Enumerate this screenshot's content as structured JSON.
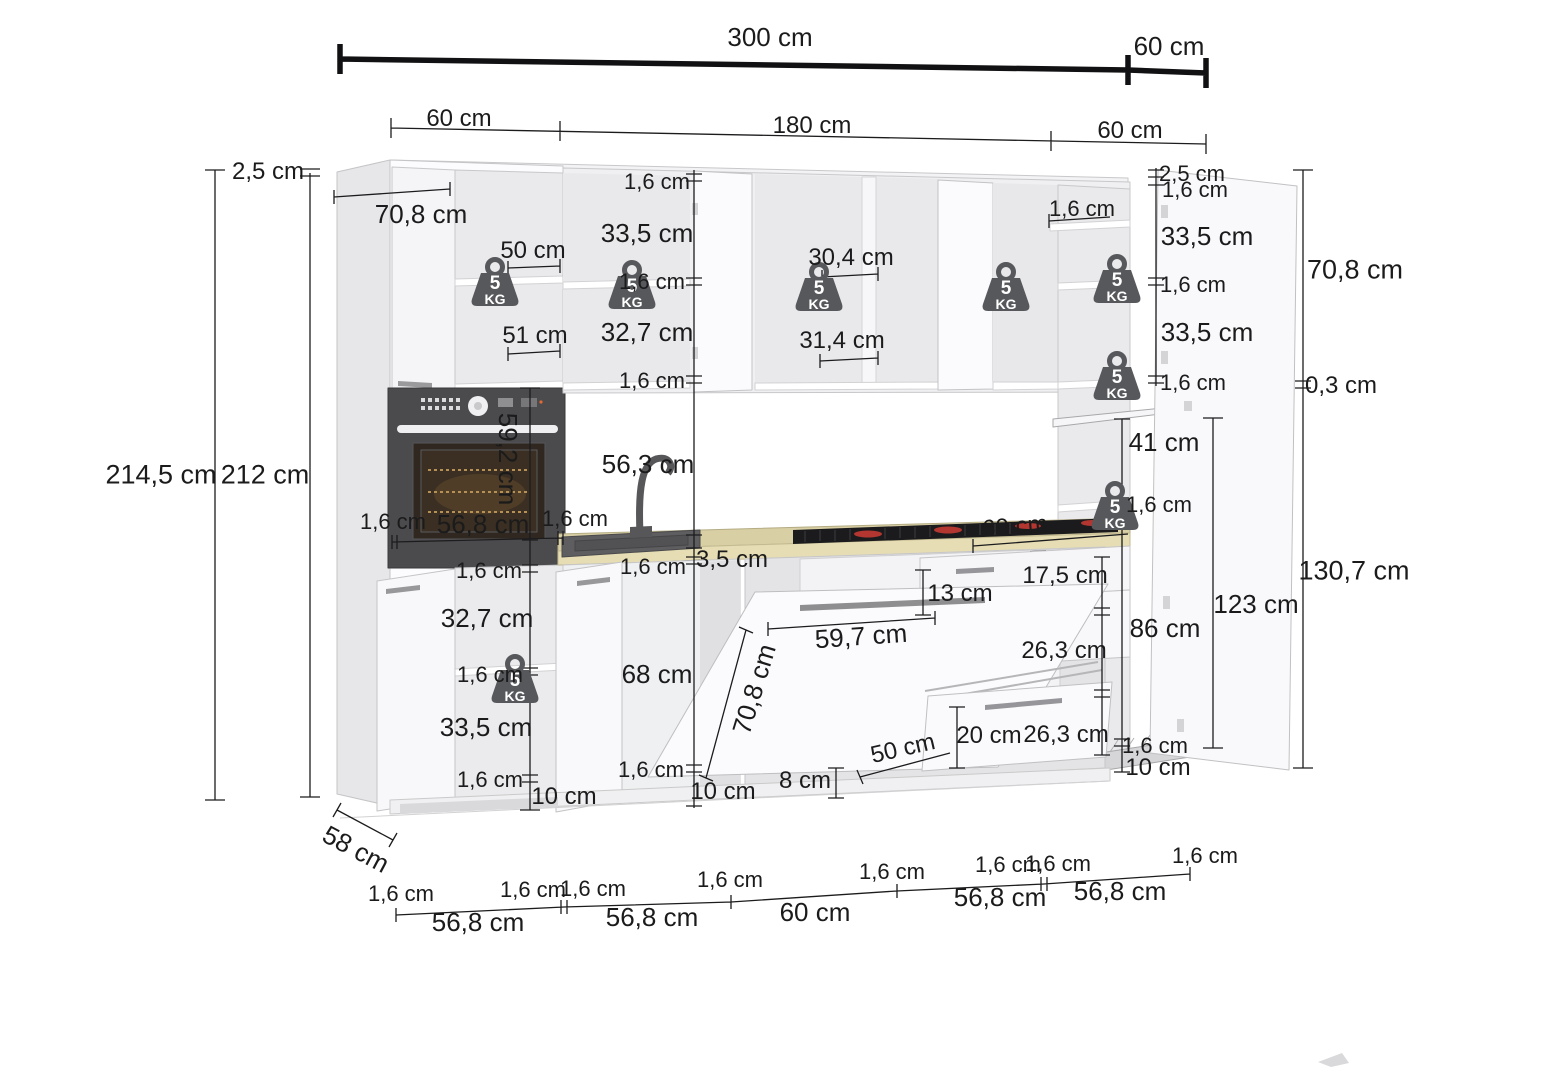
{
  "diagram": {
    "kind": "kitchen cabinet set dimensional drawing",
    "unit": "cm",
    "line_color": "#1c1c1e",
    "accent_red": "#b43630",
    "counter_color": "#d8cfa5",
    "badge_color": "#57585c"
  },
  "overall_dimensions": {
    "total_width": "300 cm",
    "right_return_width": "60 cm",
    "front_segments": [
      "60 cm",
      "180 cm",
      "60 cm"
    ],
    "total_height": "214,5 cm",
    "carcass_height": "212 cm",
    "top_gap": "2,5 cm",
    "base_depth": "58 cm",
    "tall_top_depth": "70,8 cm",
    "plinth_height": "10 cm",
    "worktop_thickness": "3,5 cm",
    "panel_thickness": "1,6 cm"
  },
  "weight_badge": {
    "line1": "5",
    "line2": "KG",
    "color": "#57585c",
    "positions": [
      {
        "x": 466,
        "y": 253
      },
      {
        "x": 603,
        "y": 256
      },
      {
        "x": 790,
        "y": 258
      },
      {
        "x": 977,
        "y": 258
      },
      {
        "x": 1088,
        "y": 250
      },
      {
        "x": 1088,
        "y": 347
      },
      {
        "x": 1086,
        "y": 477
      },
      {
        "x": 486,
        "y": 650
      }
    ]
  },
  "dimension_labels": [
    {
      "t": "300 cm",
      "x": 770,
      "y": 37,
      "s": 26
    },
    {
      "t": "60 cm",
      "x": 1169,
      "y": 46,
      "s": 26
    },
    {
      "t": "60 cm",
      "x": 459,
      "y": 119
    },
    {
      "t": "180 cm",
      "x": 812,
      "y": 126
    },
    {
      "t": "60 cm",
      "x": 1130,
      "y": 131
    },
    {
      "t": "2,5 cm",
      "x": 268,
      "y": 172
    },
    {
      "t": "70,8 cm",
      "x": 421,
      "y": 214,
      "s": 26
    },
    {
      "t": "214,5 cm",
      "x": 161,
      "y": 475,
      "s": 27
    },
    {
      "t": "212 cm",
      "x": 265,
      "y": 475,
      "s": 27
    },
    {
      "t": "1,6 cm",
      "x": 657,
      "y": 182,
      "s": 22
    },
    {
      "t": "33,5 cm",
      "x": 647,
      "y": 233,
      "s": 26
    },
    {
      "t": "50 cm",
      "x": 533,
      "y": 251
    },
    {
      "t": "1,6 cm",
      "x": 652,
      "y": 282,
      "s": 22
    },
    {
      "t": "32,7 cm",
      "x": 647,
      "y": 332,
      "s": 26
    },
    {
      "t": "51 cm",
      "x": 535,
      "y": 336
    },
    {
      "t": "1,6 cm",
      "x": 652,
      "y": 381,
      "s": 22
    },
    {
      "t": "30,4 cm",
      "x": 851,
      "y": 258
    },
    {
      "t": "31,4 cm",
      "x": 842,
      "y": 341
    },
    {
      "t": "1,6 cm",
      "x": 1082,
      "y": 209,
      "s": 22
    },
    {
      "t": "2,5 cm",
      "x": 1192,
      "y": 174,
      "s": 22
    },
    {
      "t": "1,6 cm",
      "x": 1195,
      "y": 190,
      "s": 22
    },
    {
      "t": "33,5 cm",
      "x": 1207,
      "y": 236,
      "s": 26
    },
    {
      "t": "1,6 cm",
      "x": 1193,
      "y": 285,
      "s": 22
    },
    {
      "t": "33,5 cm",
      "x": 1207,
      "y": 332,
      "s": 26
    },
    {
      "t": "1,6 cm",
      "x": 1193,
      "y": 383,
      "s": 22
    },
    {
      "t": "70,8 cm",
      "x": 1355,
      "y": 270,
      "s": 27
    },
    {
      "t": "0,3 cm",
      "x": 1341,
      "y": 386
    },
    {
      "t": "59,2 cm",
      "x": 508,
      "y": 459,
      "r": 90,
      "s": 26
    },
    {
      "t": "56,3 cm",
      "x": 648,
      "y": 464,
      "s": 26
    },
    {
      "t": "1,6 cm",
      "x": 393,
      "y": 522,
      "s": 22
    },
    {
      "t": "56,8 cm",
      "x": 483,
      "y": 524,
      "s": 26
    },
    {
      "t": "1,6 cm",
      "x": 575,
      "y": 519,
      "s": 22
    },
    {
      "t": "1,6 cm",
      "x": 653,
      "y": 567,
      "s": 22
    },
    {
      "t": "3,5 cm",
      "x": 732,
      "y": 560
    },
    {
      "t": "60 cm",
      "x": 1015,
      "y": 527,
      "r": -5
    },
    {
      "t": "1,6 cm",
      "x": 489,
      "y": 571,
      "s": 22
    },
    {
      "t": "32,7 cm",
      "x": 487,
      "y": 618,
      "s": 26
    },
    {
      "t": "1,6 cm",
      "x": 490,
      "y": 675,
      "s": 22
    },
    {
      "t": "33,5 cm",
      "x": 486,
      "y": 727,
      "s": 26
    },
    {
      "t": "1,6 cm",
      "x": 490,
      "y": 780,
      "s": 22
    },
    {
      "t": "10 cm",
      "x": 564,
      "y": 797
    },
    {
      "t": "58 cm",
      "x": 356,
      "y": 849,
      "r": 28,
      "s": 26
    },
    {
      "t": "68 cm",
      "x": 657,
      "y": 674,
      "s": 26
    },
    {
      "t": "1,6 cm",
      "x": 651,
      "y": 770,
      "s": 22
    },
    {
      "t": "10 cm",
      "x": 723,
      "y": 792
    },
    {
      "t": "70,8 cm",
      "x": 754,
      "y": 689,
      "r": -73,
      "s": 26
    },
    {
      "t": "59,7 cm",
      "x": 861,
      "y": 636,
      "r": -4,
      "s": 26
    },
    {
      "t": "13 cm",
      "x": 960,
      "y": 594
    },
    {
      "t": "8 cm",
      "x": 805,
      "y": 781
    },
    {
      "t": "50 cm",
      "x": 903,
      "y": 749,
      "r": -13
    },
    {
      "t": "17,5 cm",
      "x": 1065,
      "y": 576
    },
    {
      "t": "26,3 cm",
      "x": 1064,
      "y": 651
    },
    {
      "t": "20 cm",
      "x": 989,
      "y": 736
    },
    {
      "t": "26,3 cm",
      "x": 1066,
      "y": 735
    },
    {
      "t": "86 cm",
      "x": 1165,
      "y": 628,
      "s": 26
    },
    {
      "t": "41 cm",
      "x": 1164,
      "y": 442,
      "s": 26
    },
    {
      "t": "1,6 cm",
      "x": 1159,
      "y": 505,
      "s": 22
    },
    {
      "t": "123 cm",
      "x": 1256,
      "y": 604,
      "s": 26
    },
    {
      "t": "130,7 cm",
      "x": 1354,
      "y": 571,
      "s": 27
    },
    {
      "t": "1,6 cm",
      "x": 1155,
      "y": 746,
      "s": 22
    },
    {
      "t": "10 cm",
      "x": 1158,
      "y": 768
    },
    {
      "t": "1,6 cm",
      "x": 401,
      "y": 894,
      "s": 22
    },
    {
      "t": "56,8 cm",
      "x": 478,
      "y": 922,
      "s": 26
    },
    {
      "t": "1,6 cm",
      "x": 533,
      "y": 890,
      "s": 22
    },
    {
      "t": "1,6 cm",
      "x": 593,
      "y": 889,
      "s": 22
    },
    {
      "t": "56,8 cm",
      "x": 652,
      "y": 917,
      "s": 26
    },
    {
      "t": "1,6 cm",
      "x": 730,
      "y": 880,
      "s": 22
    },
    {
      "t": "60 cm",
      "x": 815,
      "y": 912,
      "s": 26
    },
    {
      "t": "1,6 cm",
      "x": 892,
      "y": 872,
      "s": 22
    },
    {
      "t": "56,8 cm",
      "x": 1000,
      "y": 897,
      "s": 26
    },
    {
      "t": "1,6 cm",
      "x": 1008,
      "y": 865,
      "s": 22
    },
    {
      "t": "1,6 cm",
      "x": 1058,
      "y": 864,
      "s": 22
    },
    {
      "t": "56,8 cm",
      "x": 1120,
      "y": 891,
      "s": 26
    },
    {
      "t": "1,6 cm",
      "x": 1205,
      "y": 856,
      "s": 22
    }
  ]
}
